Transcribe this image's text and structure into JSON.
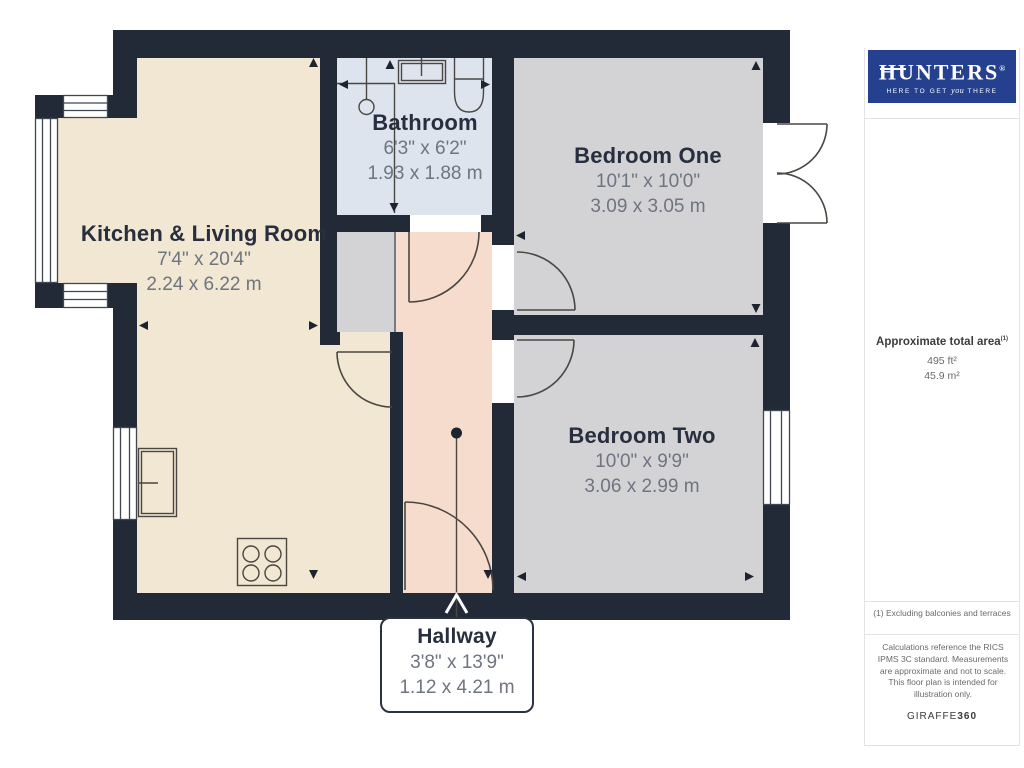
{
  "floorplan": {
    "rooms": [
      {
        "name": "Kitchen & Living Room",
        "size_imperial": "7'4\" x 20'4\"",
        "size_metric": "2.24 x 6.22 m"
      },
      {
        "name": "Bathroom",
        "size_imperial": "6'3\" x 6'2\"",
        "size_metric": "1.93 x 1.88 m"
      },
      {
        "name": "Bedroom One",
        "size_imperial": "10'1\" x 10'0\"",
        "size_metric": "3.09 x 3.05 m"
      },
      {
        "name": "Bedroom Two",
        "size_imperial": "10'0\" x 9'9\"",
        "size_metric": "3.06 x 2.99 m"
      },
      {
        "name": "Hallway",
        "size_imperial": "3'8\" x 13'9\"",
        "size_metric": "1.12 x 4.21 m"
      }
    ],
    "colors": {
      "wall": "#222a38",
      "kitchen_floor": "#f1e7d2",
      "bathroom_floor": "#dde4ee",
      "bedroom_floor": "#d3d3d5",
      "hallway_floor": "#f6dccc"
    }
  },
  "sidebar": {
    "logo": {
      "brand": "HUNTERS",
      "registered": "®",
      "tagline_pre": "HERE TO GET",
      "tagline_script": "you",
      "tagline_post": "THERE",
      "background": "#24408f"
    },
    "area_summary": {
      "heading": "Approximate total area",
      "footnote_marker": "(1)",
      "imperial": "495 ft²",
      "metric": "45.9 m²"
    },
    "footnote": "(1) Excluding balconies and terraces",
    "disclaimer": "Calculations reference the RICS IPMS 3C standard. Measurements are approximate and not to scale. This floor plan is intended for illustration only.",
    "credit": {
      "brand": "GIRAFFE",
      "suffix": "360"
    }
  }
}
